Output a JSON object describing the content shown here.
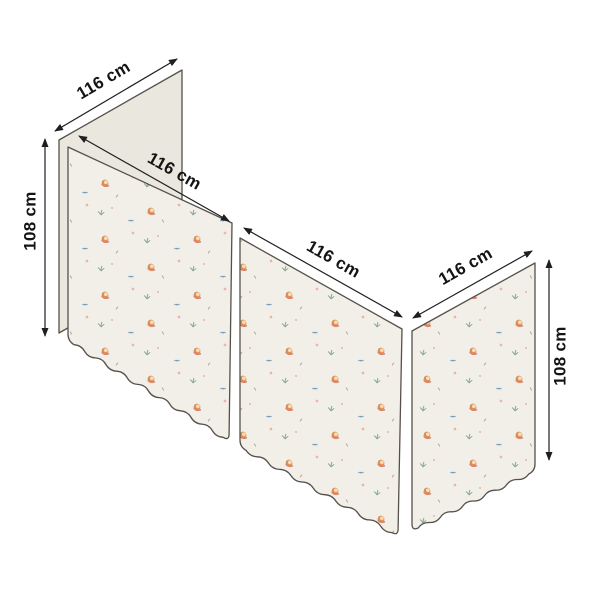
{
  "canvas": {
    "background": "#ffffff"
  },
  "diagram": {
    "name": "bed-curtain-dimension-diagram",
    "description": "three-sided bed curtain set with scalloped hem and mermaid print, annotated with dimensions",
    "fabric": {
      "base_color": "#f2efe8",
      "plain_panel_color": "#eae7df",
      "outline_color": "#55514a",
      "motifs": [
        {
          "name": "mermaid",
          "colors": [
            "#dc8f4f",
            "#f6dcba",
            "#e0816c"
          ]
        },
        {
          "name": "crescent-moon",
          "color": "#a6cbe3"
        },
        {
          "name": "sprig",
          "color": "#86a98f"
        },
        {
          "name": "bird",
          "color": "#6f9ab8"
        },
        {
          "name": "pink-mark",
          "color": "#e8a49c"
        },
        {
          "name": "tick",
          "color": "#b3a694"
        }
      ]
    },
    "dimensions": {
      "back_top_width": "116 cm",
      "left_height": "108 cm",
      "front_left_width": "116 cm",
      "front_right_width": "116 cm",
      "right_side_width": "116 cm",
      "right_height": "108 cm"
    }
  }
}
